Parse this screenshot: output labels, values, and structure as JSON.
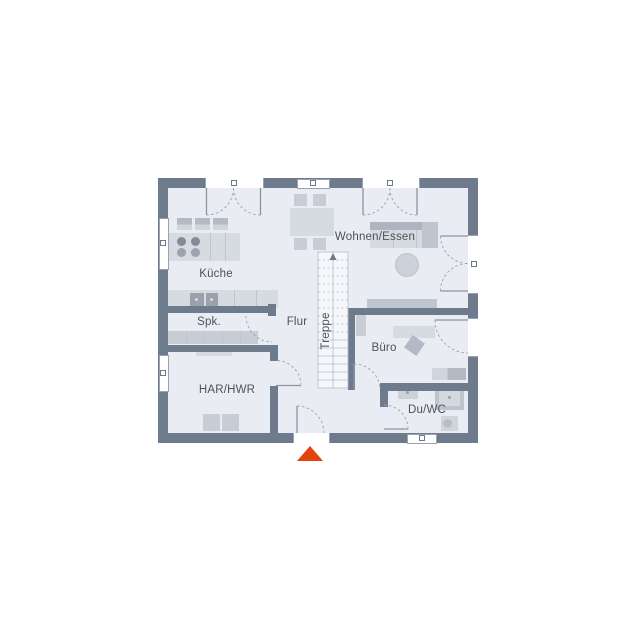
{
  "plan": {
    "type": "floor-plan",
    "storey": "ground-floor",
    "rooms": [
      {
        "id": "kueche",
        "label": "Küche"
      },
      {
        "id": "spk",
        "label": "Spk."
      },
      {
        "id": "har-hwr",
        "label": "HAR/HWR"
      },
      {
        "id": "flur",
        "label": "Flur"
      },
      {
        "id": "treppe",
        "label": "Treppe"
      },
      {
        "id": "wohnen-essen",
        "label": "Wohnen/Essen"
      },
      {
        "id": "buero",
        "label": "Büro"
      },
      {
        "id": "du-wc",
        "label": "Du/WC"
      }
    ],
    "entrance_marker": {
      "symbol": "triangle-up",
      "meaning": "entrance-arrow"
    }
  },
  "colors": {
    "wall": "#6e7b8c",
    "floor": "#e9edf3",
    "furniture_light": "#d6dae1",
    "furniture_medium": "#c7ccd5",
    "furniture_dark": "#aeb5c0",
    "line": "#8b94a1",
    "stair_line": "#b6bdc7",
    "text": "#4b515a",
    "accent_arrow": "#e2430f"
  }
}
